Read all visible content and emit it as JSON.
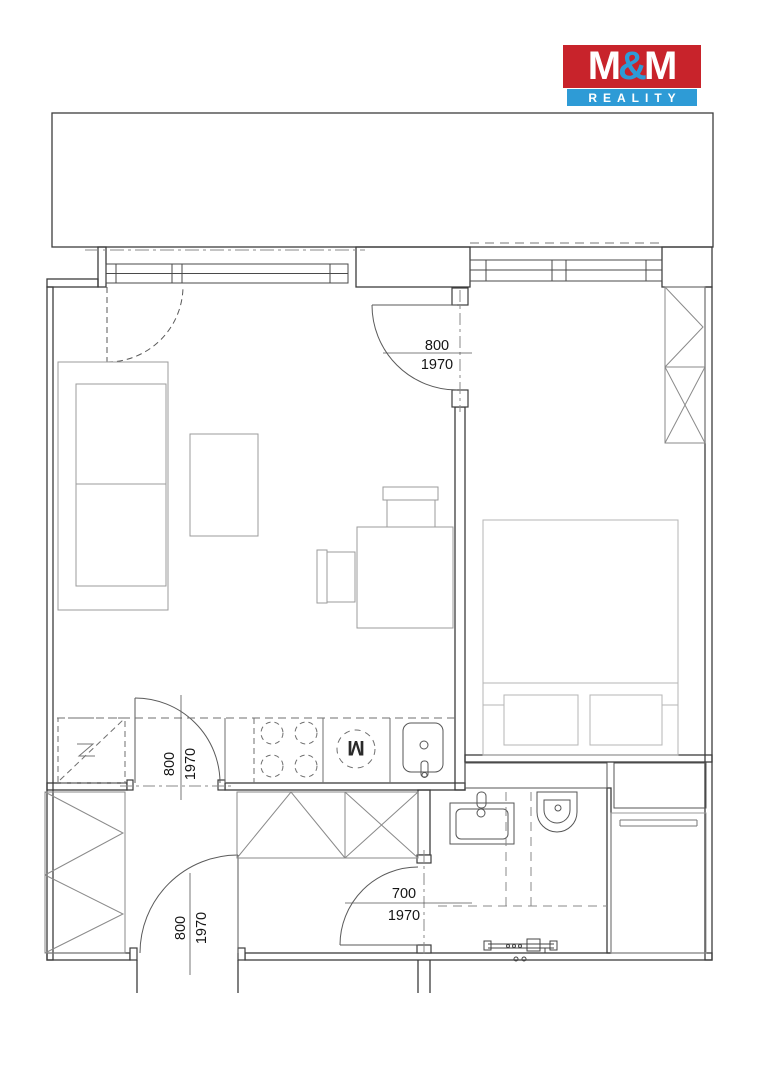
{
  "logo": {
    "m1": "M",
    "amp": "&",
    "m2": "M",
    "word": "REALITY",
    "red": "#c8232b",
    "blue": "#2e9bd6"
  },
  "doors": {
    "bedroom": {
      "width": "800",
      "height": "1970"
    },
    "living_hall": {
      "width": "800",
      "height": "1970"
    },
    "bathroom": {
      "width": "700",
      "height": "1970"
    },
    "entrance": {
      "width": "800",
      "height": "1970"
    }
  },
  "appliances": {
    "washing_machine_label": "M"
  },
  "plan_colors": {
    "wall": "#3d3d3d",
    "window": "#4a4a4a",
    "furniture": "#9b9b9b",
    "bed": "#b5b5b5",
    "fixture": "#565656",
    "dashed_guides": "#888888",
    "background": "#ffffff"
  }
}
